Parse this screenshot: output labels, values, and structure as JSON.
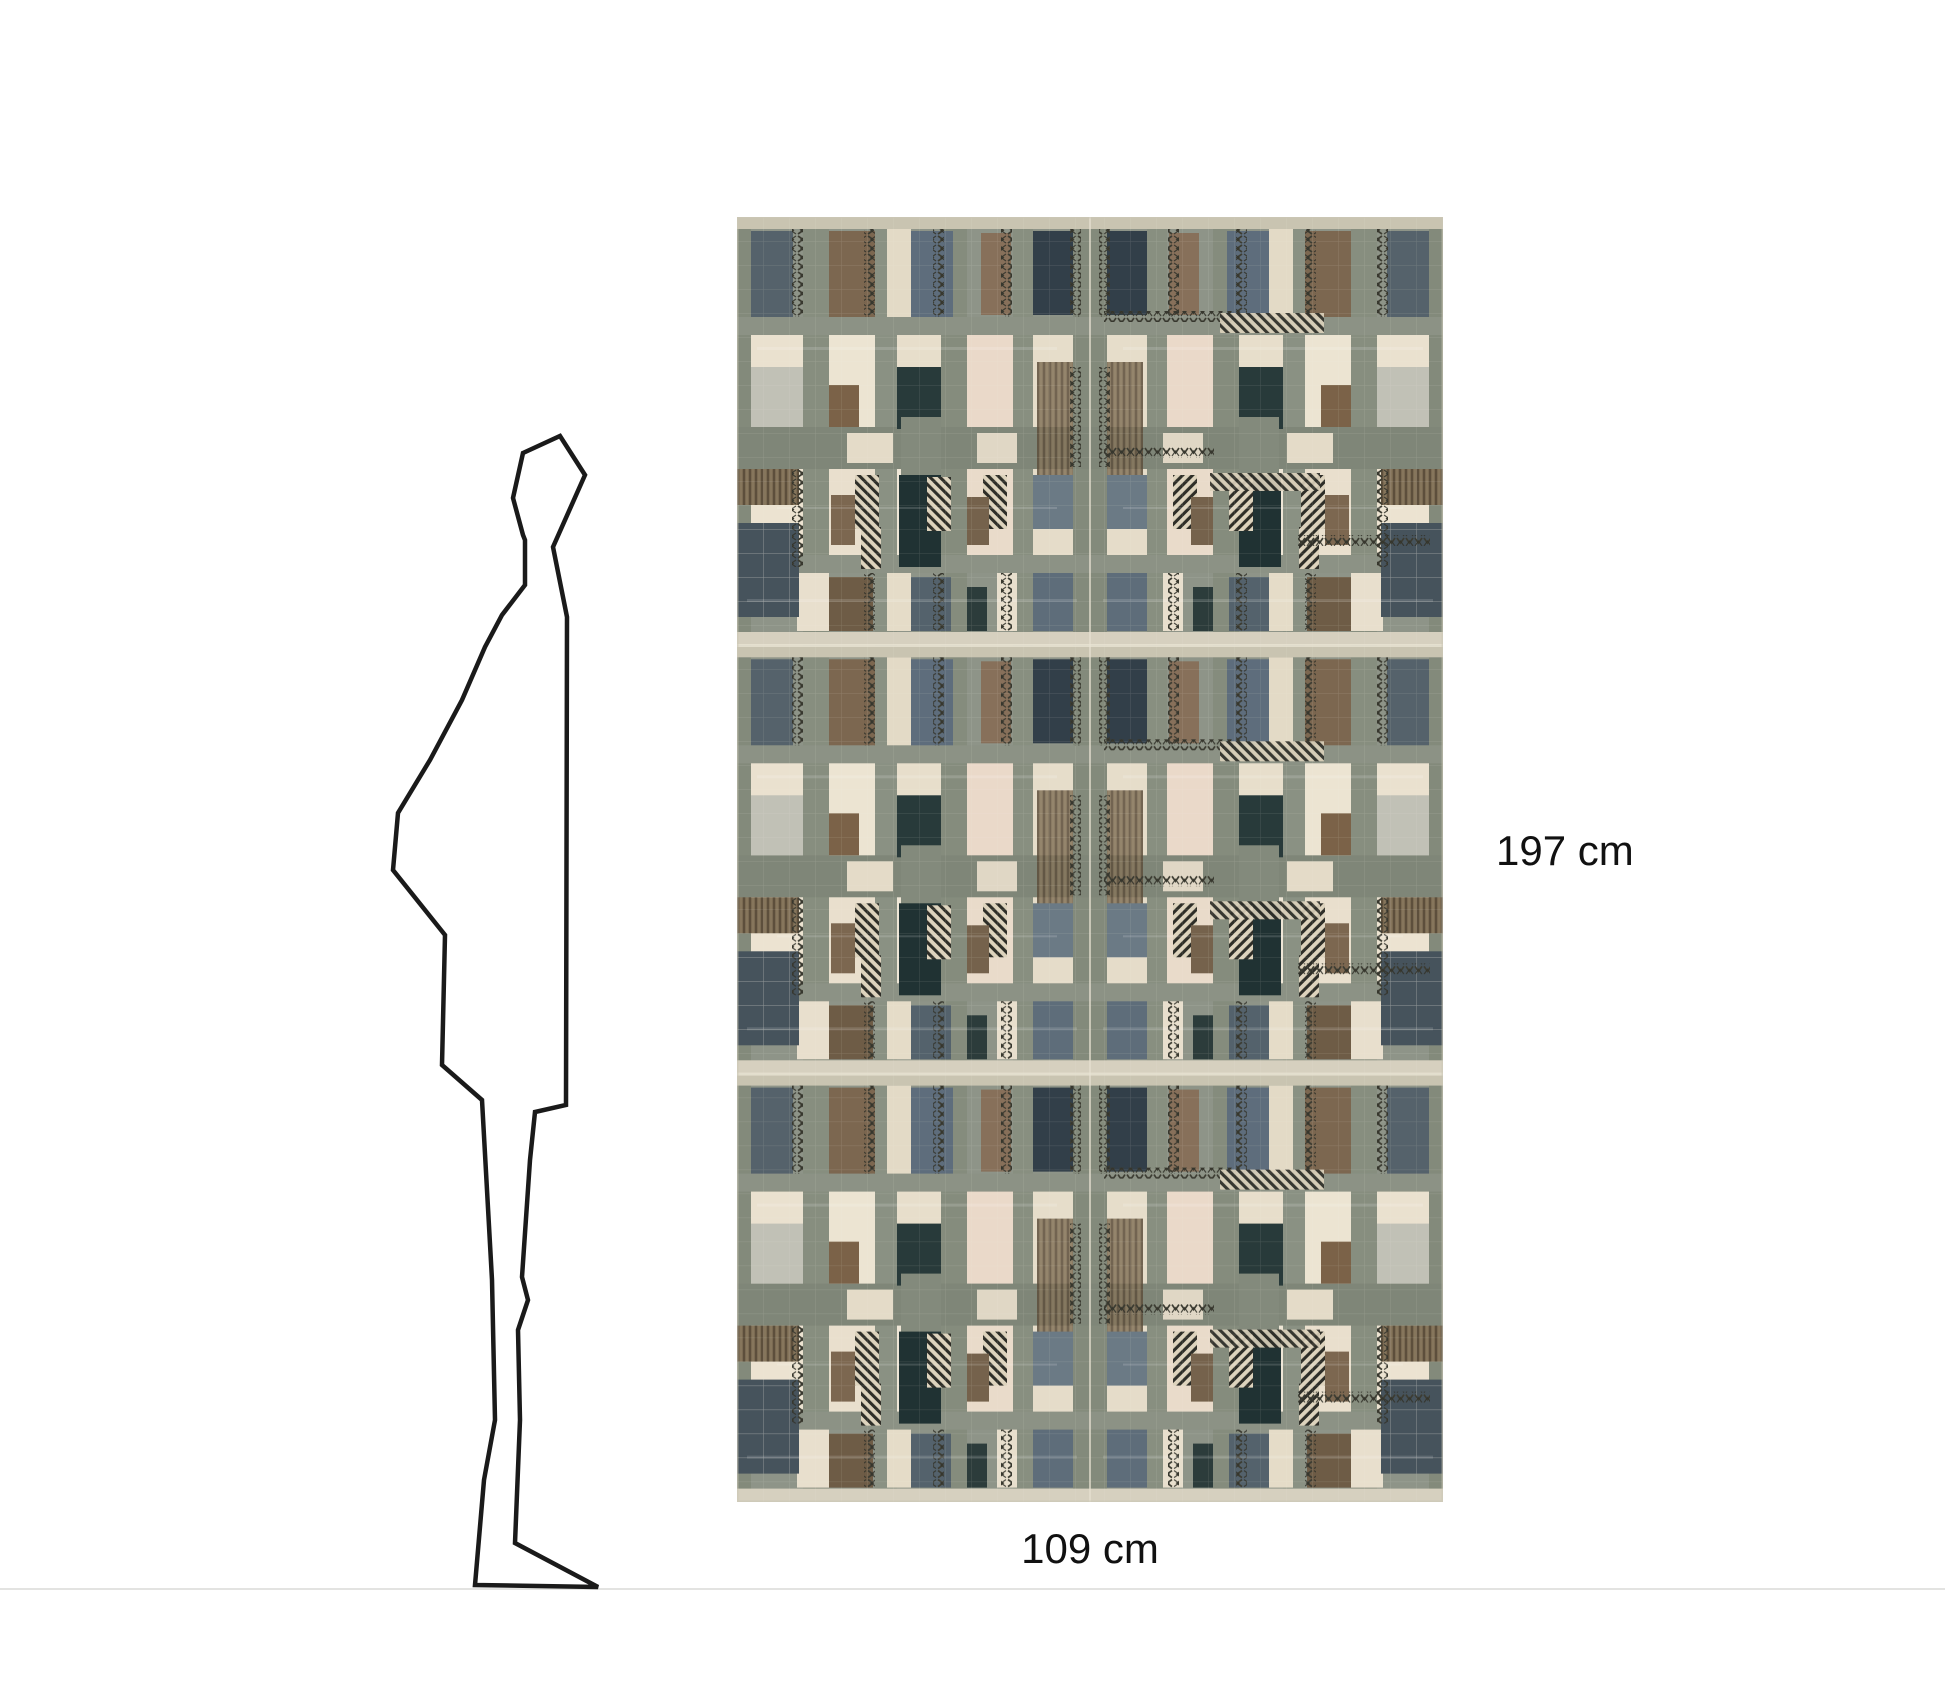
{
  "dimensions": {
    "height_label": "197 cm",
    "width_label": "109 cm"
  },
  "colors": {
    "page_background": "#ffffff",
    "label_text": "#111111",
    "floor_line": "#e3e3e1",
    "silhouette_stroke": "#1a1a1a",
    "swatch_sage": "#8e9488",
    "swatch_gray_band": "#7f8678",
    "swatch_cream": "#eae1cf",
    "swatch_pink_cream": "#ead9c9",
    "swatch_dark_teal": "#203233",
    "swatch_navy": "#323f49",
    "swatch_brown": "#7c6750",
    "swatch_slate_blue": "#5e6d7c",
    "swatch_hatch_dark": "#2e2e28"
  }
}
